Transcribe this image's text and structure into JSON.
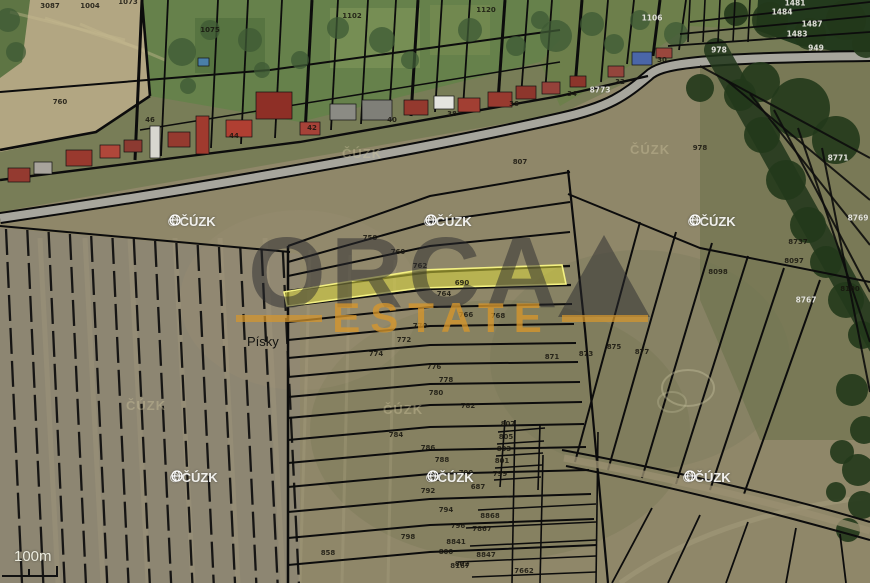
{
  "branding": {
    "copyright": "©",
    "provider": "ČÚZK",
    "brand_line1": "ORCA",
    "brand_line2": "ESTATE",
    "brand_color_dark": "#2a2a2d",
    "brand_color_orange": "#d6962c"
  },
  "labels": {
    "place": "Písky",
    "scale": "100m"
  },
  "highlight": {
    "fill": "#d9d63e",
    "stroke": "#f4f183"
  },
  "watermarks": {
    "white": [
      [
        168,
        214
      ],
      [
        424,
        214
      ],
      [
        688,
        214
      ],
      [
        170,
        470
      ],
      [
        426,
        470
      ],
      [
        683,
        470
      ]
    ],
    "faint": [
      [
        342,
        146
      ],
      [
        630,
        142
      ],
      [
        126,
        398
      ],
      [
        383,
        402
      ]
    ]
  },
  "parcel_labels_dark": [
    [
      50,
      6,
      "3087"
    ],
    [
      90,
      6,
      "1004"
    ],
    [
      128,
      2,
      "1073"
    ],
    [
      210,
      30,
      "1075"
    ],
    [
      352,
      16,
      "1102"
    ],
    [
      486,
      10,
      "1120"
    ],
    [
      60,
      102,
      "760"
    ],
    [
      150,
      120,
      "46"
    ],
    [
      234,
      136,
      "44"
    ],
    [
      312,
      128,
      "42"
    ],
    [
      392,
      120,
      "40"
    ],
    [
      452,
      114,
      "38"
    ],
    [
      514,
      104,
      "36"
    ],
    [
      572,
      94,
      "34"
    ],
    [
      620,
      82,
      "32"
    ],
    [
      662,
      60,
      "30"
    ],
    [
      700,
      148,
      "978"
    ],
    [
      520,
      162,
      "807"
    ],
    [
      370,
      238,
      "758"
    ],
    [
      398,
      252,
      "760"
    ],
    [
      420,
      266,
      "762"
    ],
    [
      462,
      283,
      "690"
    ],
    [
      444,
      294,
      "764"
    ],
    [
      466,
      315,
      "766"
    ],
    [
      498,
      316,
      "768"
    ],
    [
      420,
      326,
      "770"
    ],
    [
      404,
      340,
      "772"
    ],
    [
      376,
      354,
      "774"
    ],
    [
      434,
      367,
      "776"
    ],
    [
      446,
      380,
      "778"
    ],
    [
      436,
      393,
      "780"
    ],
    [
      468,
      406,
      "782"
    ],
    [
      396,
      435,
      "784"
    ],
    [
      428,
      448,
      "786"
    ],
    [
      442,
      460,
      "788"
    ],
    [
      466,
      473,
      "790"
    ],
    [
      428,
      491,
      "792"
    ],
    [
      446,
      510,
      "794"
    ],
    [
      458,
      526,
      "796"
    ],
    [
      408,
      537,
      "798"
    ],
    [
      446,
      552,
      "800"
    ],
    [
      462,
      564,
      "802"
    ],
    [
      328,
      553,
      "858"
    ],
    [
      552,
      357,
      "871"
    ],
    [
      586,
      354,
      "873"
    ],
    [
      614,
      347,
      "875"
    ],
    [
      642,
      352,
      "877"
    ],
    [
      798,
      242,
      "8737"
    ],
    [
      794,
      261,
      "8097"
    ],
    [
      718,
      272,
      "8098"
    ],
    [
      850,
      289,
      "8100"
    ],
    [
      508,
      424,
      "807"
    ],
    [
      506,
      437,
      "805"
    ],
    [
      504,
      449,
      "803"
    ],
    [
      502,
      461,
      "801"
    ],
    [
      500,
      474,
      "799"
    ],
    [
      478,
      487,
      "687"
    ],
    [
      434,
      479,
      "689"
    ],
    [
      490,
      516,
      "8868"
    ],
    [
      482,
      529,
      "7867"
    ],
    [
      456,
      542,
      "8841"
    ],
    [
      486,
      555,
      "8847"
    ],
    [
      460,
      566,
      "8167"
    ],
    [
      524,
      571,
      "7662"
    ]
  ],
  "parcel_labels_white": [
    [
      795,
      3,
      "1481"
    ],
    [
      782,
      12,
      "1484"
    ],
    [
      812,
      24,
      "1487"
    ],
    [
      797,
      34,
      "1483"
    ],
    [
      816,
      48,
      "949"
    ],
    [
      719,
      50,
      "978"
    ],
    [
      652,
      18,
      "1106"
    ],
    [
      600,
      90,
      "8773"
    ],
    [
      838,
      158,
      "8771"
    ],
    [
      858,
      218,
      "8769"
    ],
    [
      806,
      300,
      "8767"
    ]
  ]
}
